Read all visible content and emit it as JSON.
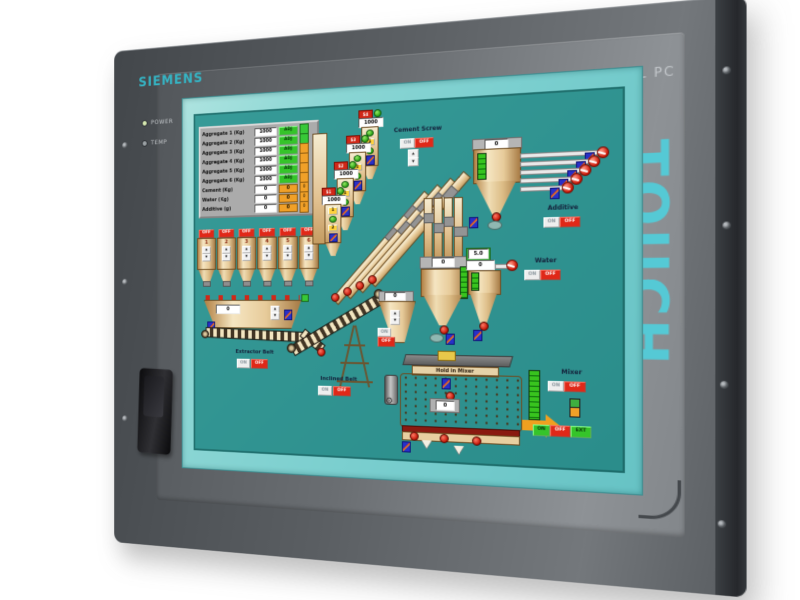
{
  "device": {
    "brand": "SIEMENS",
    "model_label": "SIMATIC PANEL PC",
    "touch_label": "TOUCH",
    "leds": {
      "power": "POWER",
      "temp": "TEMP"
    }
  },
  "labels": {
    "on": "ON",
    "off": "OFF",
    "up": "▲",
    "down": "▼"
  },
  "hmi": {
    "recipe_table": {
      "rows": [
        {
          "label": "Aggregate 1 (Kg)",
          "value": "1000",
          "action": "ADJ",
          "side": ""
        },
        {
          "label": "Aggregate 2 (Kg)",
          "value": "1000",
          "action": "ADJ",
          "side": ""
        },
        {
          "label": "Aggregate 3 (Kg)",
          "value": "1000",
          "action": "ADJ",
          "side": ""
        },
        {
          "label": "Aggregate 4 (Kg)",
          "value": "1000",
          "action": "ADJ",
          "side": ""
        },
        {
          "label": "Aggregate 5 (Kg)",
          "value": "1000",
          "action": "ADJ",
          "side": ""
        },
        {
          "label": "Aggregate 6 (Kg)",
          "value": "1000",
          "action": "ADJ",
          "side": ""
        },
        {
          "label": "Cement (Kg)",
          "value": "0",
          "action": "0",
          "side": "0"
        },
        {
          "label": "Water (Kg)",
          "value": "0",
          "action": "0",
          "side": "0"
        },
        {
          "label": "Additive (g)",
          "value": "0",
          "action": "0",
          "side": "0"
        }
      ]
    },
    "aggregate_bins": {
      "numbers": [
        "1",
        "2",
        "3",
        "4",
        "5",
        "6"
      ]
    },
    "extractor_belt": {
      "label": "Extractor Belt",
      "hopper_value": "0"
    },
    "cement_silos": {
      "tags": [
        "S1",
        "S2",
        "S3",
        "S4"
      ],
      "value": "1000",
      "btn": "1",
      "btn2": "2"
    },
    "cement_screw": {
      "label": "Cement Screw"
    },
    "weigh_hopper": {
      "value": "0"
    },
    "additive": {
      "label": "Additive",
      "hopper_value": "0"
    },
    "water": {
      "label": "Water",
      "flow": "5.0",
      "value": "0"
    },
    "inclined_belt": {
      "label": "Inclined Belt"
    },
    "mixer_feed": {
      "value": "0"
    },
    "mixer": {
      "label": "Mixer",
      "title": "Hold in Mixer",
      "value": "0",
      "controls": [
        "ON",
        "OFF",
        "EXT"
      ]
    }
  }
}
